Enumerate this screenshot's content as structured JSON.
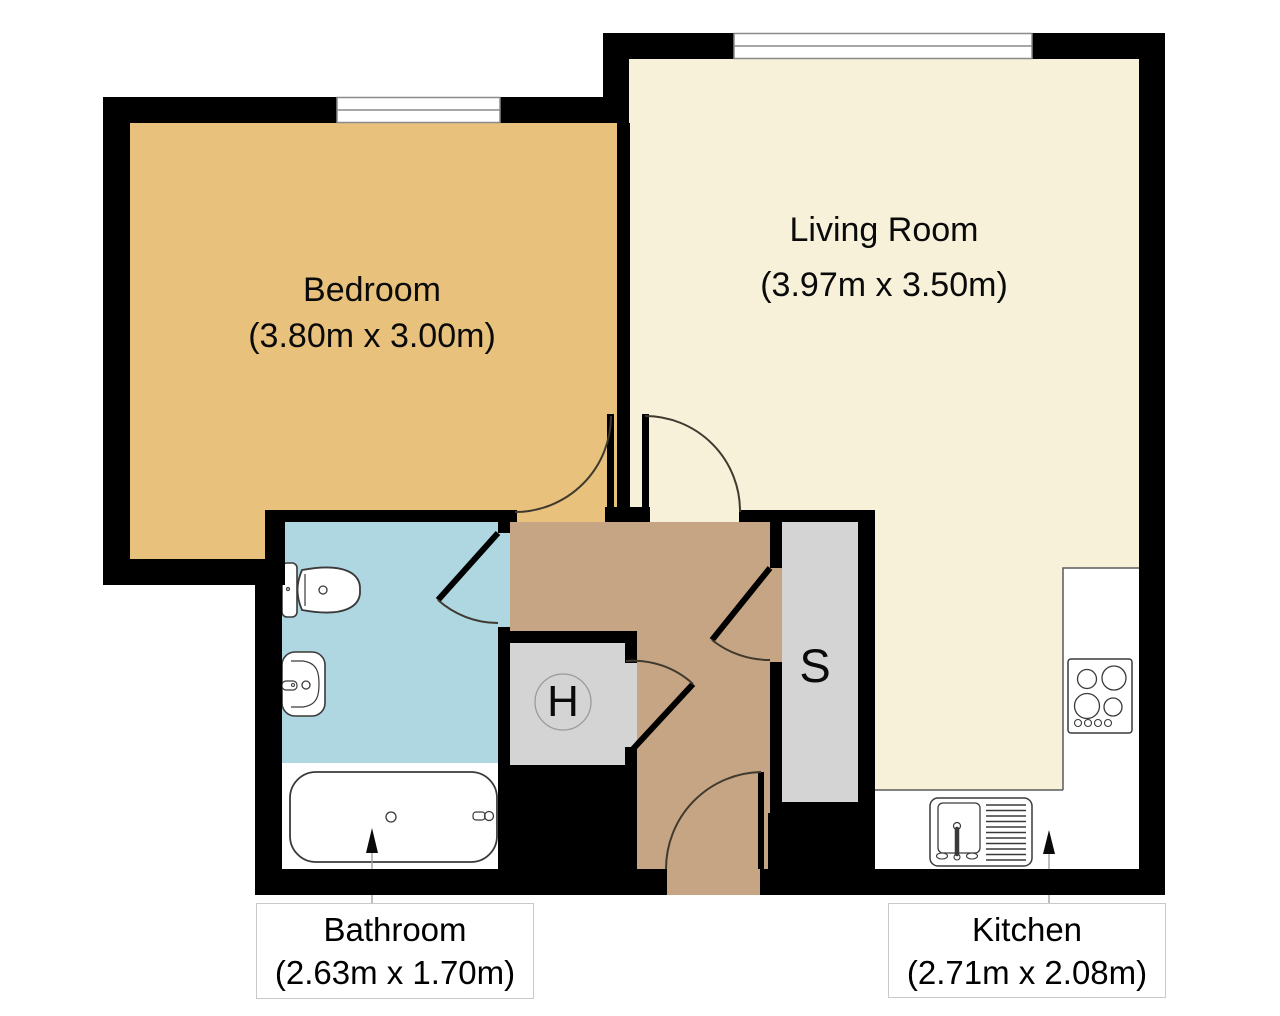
{
  "rooms": {
    "bedroom": {
      "name": "Bedroom",
      "dims": "(3.80m x 3.00m)",
      "floor_color": "#e8c27d"
    },
    "living_room": {
      "name": "Living Room",
      "dims": "(3.97m x 3.50m)",
      "floor_color": "#f8f1da"
    },
    "bathroom": {
      "name": "Bathroom",
      "dims": "(2.63m x 1.70m)",
      "floor_color": "#aed7e2"
    },
    "kitchen": {
      "name": "Kitchen",
      "dims": "(2.71m x 2.08m)"
    }
  },
  "closets": {
    "h": {
      "label": "H"
    },
    "s": {
      "label": "S"
    }
  },
  "colors": {
    "wall": "#000000",
    "hallway_floor": "#c5a584",
    "closet_floor": "#d4d4d4",
    "counter": "#ffffff",
    "window": "#ffffff"
  }
}
